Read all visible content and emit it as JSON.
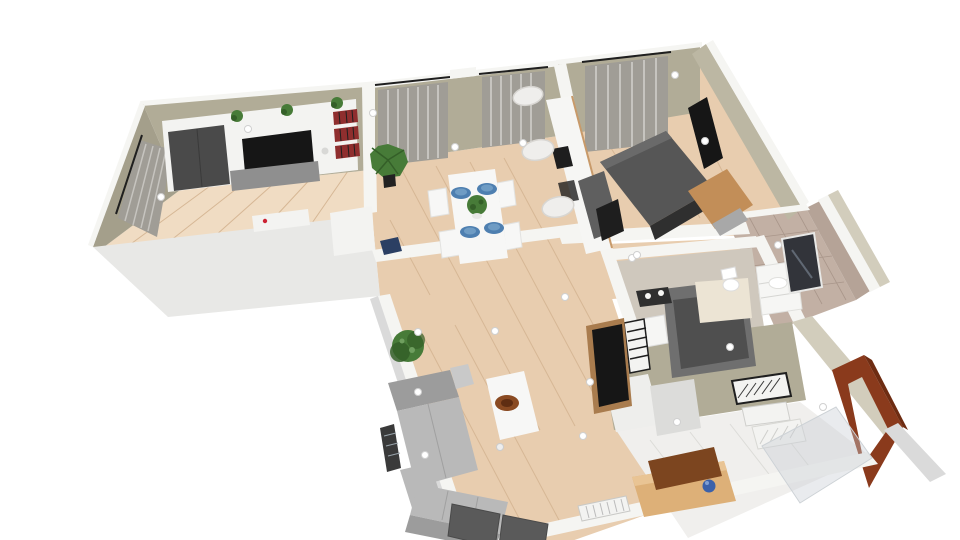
{
  "meta": {
    "type": "3d-floorplan-render",
    "view": "rotated top-down perspective of an L-shaped apartment",
    "background": "#ffffff",
    "canvas": {
      "width": 960,
      "height": 540
    },
    "ceiling_light_count": 20
  },
  "colors": {
    "bg": "#ffffff",
    "wall_sage": "#b1ac97",
    "wall_sage_dark": "#a49f8b",
    "wall_sage_light": "#bcb7a3",
    "wall_cream": "#d2cdbc",
    "wall_top": "#f5f5f2",
    "wall_face_light": "#e8e8e6",
    "wall_face_bright": "#eeeeec",
    "door_gray": "#dcdcda",
    "floor_wood": "#e8cdaf",
    "floor_wood_light": "#f0dcc3",
    "plank_line": "#d6b795",
    "floor_gray": "#cfc8bd",
    "tile_taupe": "#c2b0a4",
    "tile_wall": "#b5a397",
    "tile_line": "#a9968a",
    "entry_tile": "#f0efed",
    "entry_line": "#dcdcd8",
    "curtain": "#a09d96",
    "curtain_light": "#c6c4bf",
    "rod_black": "#1f1f1f",
    "unit_white": "#f3f3f1",
    "wardrobe_gray": "#4a4a4a",
    "tv_black": "#161616",
    "books_red": "#8f2e2e",
    "sideboard_gray": "#8f8f8f",
    "bed_gray": "#565656",
    "bed_light": "#6a6a6a",
    "bed_base": "#2f2f2f",
    "wood_oak": "#c28e58",
    "oak_gray": "#a8a8a8",
    "counter_white": "#f6f6f4",
    "counter_edge": "#c89a6a",
    "appliance_gray": "#5f5f5f",
    "appliance_black": "#1e1e1e",
    "stool_white": "#efeeec",
    "stool_rim": "#d8d6d2",
    "sofa_gray": "#b9b9b9",
    "sofa_dark": "#9c9c9c",
    "sofa_light": "#c9c9c9",
    "sofa_seam": "#a0a0a0",
    "table_white": "#f7f7f6",
    "plate_blue": "#4e7fb0",
    "plate_blue_light": "#6f9cc4",
    "plant_green": "#477b38",
    "plant_dark": "#345f28",
    "pot_black": "#222222",
    "bowl_brown": "#8a4a22",
    "bowl_dark": "#5f2d12",
    "tv_panel": "#5a5a5a",
    "radiator_white": "#f3f3f1",
    "shower_gray": "#6f6f6f",
    "shower_dark": "#4f4f4f",
    "cream_panel": "#ece4d4",
    "vanity_white": "#f6f6f4",
    "mirror_dark": "#32343a",
    "mirror_streak": "#7f8b99",
    "door_brown": "#8a3a1c",
    "door_brown_dark": "#6e2c12",
    "tan_wood": "#ddb078",
    "tan_wood_light": "#e9c494",
    "board_brown": "#7c451f",
    "ball_blue": "#3b61aa",
    "ball_highlight": "#7f9fd4",
    "laptop_navy": "#2b3f63",
    "glass": "rgba(200,206,212,0.40)",
    "glass_edge": "#cdd2d6",
    "shadow_gray": "#dadada",
    "dot_ring": "#d0d0d0",
    "hatch_dark": "#3a3a3a",
    "black_wood_frame": "#a97c4e",
    "red_accent": "#cc2233",
    "white": "#ffffff"
  },
  "scene": {
    "rooms": [
      {
        "name": "office-tv-room",
        "furniture": [
          "tv-wall-unit",
          "dark-wardrobe",
          "wall-tv",
          "bookshelf",
          "gray-sideboard",
          "desk",
          "laptop",
          "white-dresser",
          "window-curtains",
          "shelf-plants"
        ]
      },
      {
        "name": "dining-area",
        "furniture": [
          "white-dining-table",
          "four-chairs",
          "four-blue-plates",
          "green-centerpiece",
          "palm-plant",
          "two-curtained-windows"
        ]
      },
      {
        "name": "kitchen",
        "furniture": [
          "white-counter",
          "cooktop",
          "fridge",
          "three-bar-stools"
        ]
      },
      {
        "name": "bedroom",
        "furniture": [
          "dark-double-bed",
          "wall-mounted-tv",
          "oak-wardrobe",
          "window-curtains"
        ]
      },
      {
        "name": "shower-room",
        "furniture": [
          "shower-cabin",
          "white-sink",
          "dark-vanity",
          "towel-radiator",
          "black-wardrobe"
        ]
      },
      {
        "name": "bathroom",
        "furniture": [
          "white-vanity-sink",
          "dark-mirror",
          "toilet",
          "tiled-floor"
        ]
      },
      {
        "name": "living-room",
        "furniture": [
          "gray-corner-sofa",
          "white-coffee-table",
          "brown-bowl",
          "tv-panels",
          "radiator",
          "tan-sideboard",
          "leaning-board",
          "blue-ball",
          "bushy-plant"
        ]
      },
      {
        "name": "entry-hall",
        "furniture": [
          "open-brown-door",
          "glass-panel",
          "wall-grille",
          "floor-mat"
        ]
      }
    ],
    "counts": {
      "plates": 4,
      "chairs": 4,
      "bar_stools": 3,
      "shelf_plants": 3
    }
  }
}
